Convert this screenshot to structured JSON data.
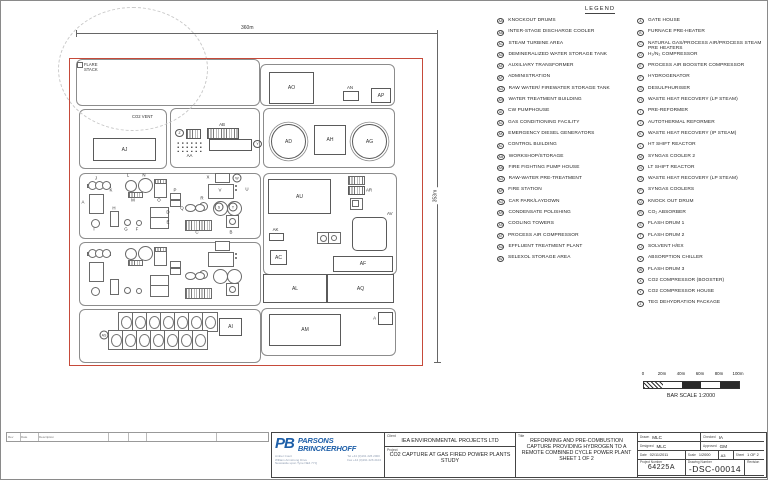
{
  "colors": {
    "boundary_red": "#c64a3a",
    "logo_blue": "#1e5fa8"
  },
  "legend": {
    "title": "LEGEND",
    "left": [
      {
        "code": "AA",
        "label": "KNOCKOUT DRUMS"
      },
      {
        "code": "AB",
        "label": "INTER-STAGE DISCHARGE COOLER"
      },
      {
        "code": "AC",
        "label": "STEAM TURBINE AREA"
      },
      {
        "code": "AD",
        "label": "DEMINERALIZED WATER STORAGE TANK"
      },
      {
        "code": "AE",
        "label": "AUXILIARY TRANSFORMER"
      },
      {
        "code": "AF",
        "label": "ADMINISTRATION"
      },
      {
        "code": "AG",
        "label": "RAW WATER/ FIREWATER STORAGE TANK"
      },
      {
        "code": "AH",
        "label": "WATER TREATMENT BUILDING"
      },
      {
        "code": "AI",
        "label": "CW PUMPHOUSE"
      },
      {
        "code": "AJ",
        "label": "GAS CONDITIONING FACILITY"
      },
      {
        "code": "AK",
        "label": "EMERGENCY DIESEL GENERATORS"
      },
      {
        "code": "AL",
        "label": "CONTROL BUILDING"
      },
      {
        "code": "AM",
        "label": "WORKSHOP/STORAGE"
      },
      {
        "code": "AN",
        "label": "FIRE FIGHTING PUMP HOUSE"
      },
      {
        "code": "AO",
        "label": "RAW-WATER PRE-TREATMENT"
      },
      {
        "code": "AP",
        "label": "FIRE STATION"
      },
      {
        "code": "AQ",
        "label": "CAR PARK/LAYDOWN"
      },
      {
        "code": "AR",
        "label": "CONDENSATE POLISHING"
      },
      {
        "code": "AS",
        "label": "COOLING TOWERS"
      },
      {
        "code": "AT",
        "label": "PROCESS AIR COMPRESSOR"
      },
      {
        "code": "AU",
        "label": "EFFLUENT TREATMENT PLANT"
      },
      {
        "code": "AV",
        "label": "SELEXOL STORAGE AREA"
      }
    ],
    "right": [
      {
        "code": "A",
        "label": "GATE HOUSE"
      },
      {
        "code": "B",
        "label": "FURNACE PRE-HEATER"
      },
      {
        "code": "C",
        "label": "NATURAL GAS/PROCESS AIR/PROCESS STEAM PRE HEATERS"
      },
      {
        "code": "D",
        "label": "H₂/N₂ COMPRESSOR"
      },
      {
        "code": "E",
        "label": "PROCESS AIR BOOSTER COMPRESSOR"
      },
      {
        "code": "F",
        "label": "HYDROGENATOR"
      },
      {
        "code": "G",
        "label": "DESULPHURISER"
      },
      {
        "code": "H",
        "label": "WASTE HEAT RECOVERY (LP STEAM)"
      },
      {
        "code": "I",
        "label": "PRE-REFORMER"
      },
      {
        "code": "J",
        "label": "AUTOTHERMAL REFORMER"
      },
      {
        "code": "K",
        "label": "WASTE HEAT RECOVERY (IP STEAM)"
      },
      {
        "code": "L",
        "label": "HT SHIFT REACTOR"
      },
      {
        "code": "M",
        "label": "SYNGAS COOLER 2"
      },
      {
        "code": "N",
        "label": "LT SHIFT REACTOR"
      },
      {
        "code": "O",
        "label": "WASTE HEAT RECOVERY (LP STEAM)"
      },
      {
        "code": "P",
        "label": "SYNGAS COOLERS"
      },
      {
        "code": "Q",
        "label": "KNOCK OUT DRUM"
      },
      {
        "code": "R",
        "label": "CO₂ ABSORBER"
      },
      {
        "code": "S",
        "label": "FLASH DRUM 1"
      },
      {
        "code": "T",
        "label": "FLASH DRUM 2"
      },
      {
        "code": "U",
        "label": "SOLVENT H/EX"
      },
      {
        "code": "V",
        "label": "ABSORPTION CHILLER"
      },
      {
        "code": "W",
        "label": "FLASH DRUM 3"
      },
      {
        "code": "X",
        "label": "CO2 COMPRESSOR (BOOSTER)"
      },
      {
        "code": "Y",
        "label": "CO2 COMPRESSOR HOUSE"
      },
      {
        "code": "Z",
        "label": "TEG DEHYDRATION PACKAGE"
      }
    ]
  },
  "scale_bar": {
    "ticks": [
      "0",
      "20m",
      "40m",
      "60m",
      "80m",
      "100m"
    ],
    "segments": [
      "zig",
      "white",
      "black",
      "white",
      "black"
    ],
    "caption": "BAR SCALE 1:2000"
  },
  "plot": {
    "width_dim": "360m",
    "height_dim": "353m",
    "flare_stack": "FLARE STACK",
    "co2_vent": "CO2 VENT",
    "containers": [
      [
        75,
        58,
        182,
        45
      ],
      [
        78,
        108,
        86,
        58
      ],
      [
        169,
        107,
        88,
        58
      ],
      [
        262,
        107,
        130,
        58
      ],
      [
        259,
        63,
        133,
        40
      ],
      [
        78,
        172,
        180,
        64
      ],
      [
        78,
        241,
        180,
        62
      ],
      [
        78,
        308,
        180,
        52
      ],
      [
        262,
        172,
        132,
        100
      ],
      [
        260,
        307,
        133,
        46
      ]
    ],
    "blocks": [
      {
        "code": "AJ",
        "x": 92,
        "y": 137,
        "w": 61,
        "h": 21,
        "lp": "in"
      },
      {
        "code": "AB",
        "x": 206,
        "y": 127,
        "w": 30,
        "h": 9,
        "lp": "above",
        "hatch": true
      },
      {
        "code": "Z",
        "x": 185,
        "y": 128,
        "w": 13,
        "h": 8,
        "lp": "left",
        "hatch": true,
        "circ": true
      },
      {
        "code": "Y",
        "x": 208,
        "y": 138,
        "w": 41,
        "h": 10,
        "lp": "right",
        "circ": true
      },
      {
        "code": "AA",
        "x": 175,
        "y": 140,
        "w": 27,
        "h": 11,
        "lp": "below",
        "dots": true
      },
      {
        "code": "AD",
        "x": 270,
        "y": 123,
        "w": 33,
        "h": 33,
        "lp": "in",
        "round": true,
        "dbl": true
      },
      {
        "code": "AH",
        "x": 313,
        "y": 124,
        "w": 30,
        "h": 28,
        "lp": "in"
      },
      {
        "code": "AG",
        "x": 351,
        "y": 123,
        "w": 33,
        "h": 33,
        "lp": "in",
        "round": true,
        "dbl": true
      },
      {
        "code": "AO",
        "x": 268,
        "y": 71,
        "w": 43,
        "h": 30,
        "lp": "in"
      },
      {
        "code": "AN",
        "x": 342,
        "y": 90,
        "w": 14,
        "h": 8,
        "lp": "above"
      },
      {
        "code": "AP",
        "x": 370,
        "y": 87,
        "w": 18,
        "h": 13,
        "lp": "in"
      },
      {
        "code": "AU",
        "x": 267,
        "y": 178,
        "w": 61,
        "h": 33,
        "lp": "in"
      },
      {
        "code": "AR",
        "x": 347,
        "y": 185,
        "w": 15,
        "h": 7,
        "lp": "right",
        "hatch": true
      },
      {
        "code": "AK",
        "x": 268,
        "y": 232,
        "w": 13,
        "h": 6,
        "lp": "above"
      },
      {
        "code": "AC",
        "x": 269,
        "y": 249,
        "w": 15,
        "h": 13,
        "lp": "in"
      },
      {
        "code": "AV",
        "x": 351,
        "y": 216,
        "w": 33,
        "h": 32,
        "lp": "ne",
        "rrect": true
      },
      {
        "code": "AF",
        "x": 332,
        "y": 255,
        "w": 58,
        "h": 14,
        "lp": "in"
      },
      {
        "code": "AL",
        "x": 262,
        "y": 273,
        "w": 62,
        "h": 27,
        "lp": "in"
      },
      {
        "code": "AQ",
        "x": 326,
        "y": 273,
        "w": 65,
        "h": 27,
        "lp": "in"
      },
      {
        "code": "AM",
        "x": 268,
        "y": 313,
        "w": 70,
        "h": 30,
        "lp": "in"
      },
      {
        "code": "A",
        "x": 377,
        "y": 311,
        "w": 13,
        "h": 11,
        "lp": "left"
      },
      {
        "code": "AI",
        "x": 218,
        "y": 317,
        "w": 21,
        "h": 16,
        "lp": "in"
      }
    ],
    "extra_shapes": [
      [
        347,
        175,
        15,
        7,
        "hatch"
      ],
      [
        349,
        197,
        11,
        10,
        "rect"
      ],
      [
        351,
        199,
        5,
        5,
        "rect"
      ],
      [
        358,
        222,
        15,
        15,
        "circle"
      ],
      [
        372,
        239,
        6,
        6,
        "circle"
      ],
      [
        316,
        231,
        11,
        10,
        "rect"
      ],
      [
        327,
        231,
        11,
        10,
        "rect"
      ],
      [
        319,
        234,
        5,
        5,
        "circle"
      ],
      [
        330,
        234,
        4,
        4,
        "circle"
      ],
      [
        211,
        140,
        35,
        6,
        "rect"
      ],
      [
        76,
        61,
        4,
        4,
        "rect"
      ]
    ],
    "train_offsets": [
      0,
      68
    ],
    "train_shapes": [
      [
        86,
        183,
        22,
        2,
        "rect"
      ],
      [
        87,
        180,
        7,
        7,
        "circle"
      ],
      [
        94,
        180,
        7,
        7,
        "circle"
      ],
      [
        101,
        180,
        7,
        7,
        "circle"
      ],
      [
        88,
        193,
        13,
        18,
        "rect"
      ],
      [
        124,
        179,
        10,
        10,
        "circle"
      ],
      [
        137,
        177,
        13,
        13,
        "circle"
      ],
      [
        127,
        191,
        13,
        4,
        "hatch"
      ],
      [
        153,
        181,
        11,
        14,
        "rect"
      ],
      [
        153,
        178,
        11,
        3,
        "hatch"
      ],
      [
        169,
        192,
        9,
        5,
        "rect"
      ],
      [
        169,
        199,
        9,
        5,
        "rect"
      ],
      [
        149,
        206,
        17,
        10,
        "rect"
      ],
      [
        149,
        216,
        17,
        10,
        "rect"
      ],
      [
        109,
        210,
        7,
        14,
        "rect"
      ],
      [
        90,
        218,
        7,
        7,
        "circle"
      ],
      [
        123,
        218,
        5,
        5,
        "circle"
      ],
      [
        135,
        219,
        4,
        4,
        "circle"
      ],
      [
        214,
        172,
        13,
        8,
        "rect"
      ],
      [
        233,
        183,
        5,
        9,
        "dots"
      ],
      [
        207,
        183,
        24,
        13,
        "rect"
      ],
      [
        198,
        201,
        7,
        7,
        "circle"
      ],
      [
        184,
        203,
        9,
        6,
        "circle"
      ],
      [
        194,
        203,
        8,
        6,
        "circle"
      ],
      [
        212,
        200,
        13,
        13,
        "circle"
      ],
      [
        226,
        200,
        13,
        13,
        "circle"
      ],
      [
        184,
        219,
        25,
        9,
        "hatch"
      ],
      [
        225,
        214,
        11,
        11,
        "rect"
      ],
      [
        228,
        217,
        5,
        5,
        "circle"
      ]
    ],
    "markers": [
      [
        "J",
        95,
        177,
        0
      ],
      [
        "K",
        110,
        189,
        0
      ],
      [
        "L",
        127,
        174,
        0
      ],
      [
        "N",
        143,
        174,
        0
      ],
      [
        "M",
        132,
        199,
        0
      ],
      [
        "O",
        158,
        199,
        0
      ],
      [
        "P",
        174,
        189,
        0
      ],
      [
        "D",
        167,
        211,
        0
      ],
      [
        "E",
        167,
        221,
        0
      ],
      [
        "H",
        113,
        207,
        0
      ],
      [
        "I",
        93,
        228,
        0
      ],
      [
        "G",
        125,
        228,
        0
      ],
      [
        "F",
        136,
        228,
        0
      ],
      [
        "A",
        82,
        201,
        0
      ],
      [
        "X",
        207,
        176,
        0
      ],
      [
        "W",
        236,
        177,
        1
      ],
      [
        "V",
        219,
        189,
        0
      ],
      [
        "U",
        246,
        188,
        0
      ],
      [
        "R",
        201,
        197,
        0
      ],
      [
        "Q",
        181,
        207,
        0
      ],
      [
        "S",
        218,
        206,
        1
      ],
      [
        "T",
        232,
        206,
        1
      ],
      [
        "C",
        196,
        231,
        0
      ],
      [
        "B",
        230,
        231,
        0
      ],
      [
        "AS",
        103,
        334,
        1
      ]
    ],
    "cooling": {
      "r1": [
        117,
        311
      ],
      "r2": [
        107,
        329
      ],
      "cols": 7,
      "cw": 14,
      "ch": 18
    }
  },
  "title_block": {
    "company": {
      "logo": "PB",
      "name1": "PARSONS",
      "name2": "BRINCKERHOFF",
      "address": [
        "Amber Court",
        "William Armstrong Drive",
        "Newcastle upon Tyne NE4 7YQ"
      ],
      "tel": "Tel  +44 (0)191 226 2000",
      "fax": "Fax  +44 (0)191 226 2104"
    },
    "client_label": "Client",
    "client": "IEA ENVIRONMENTAL PROJECTS LTD",
    "project_label": "Project",
    "project": "CO2 CAPTURE AT GAS FIRED POWER PLANTS STUDY",
    "title_label": "Title",
    "title": "REFORMING AND PRE-COMBUSTION CAPTURE PROVIDING HYDROGEN TO A REMOTE COMBINED CYCLE POWER PLANT SHEET 1 OF 2",
    "drawn_label": "Drawn",
    "drawn": "MLC",
    "checked_label": "Checked",
    "checked": "IA",
    "designed_label": "Designed",
    "designed": "MLC",
    "approved_label": "Approved",
    "approved": "GM",
    "date_label": "Date",
    "date": "02/11/2011",
    "scale_label": "Scale",
    "scale": "1/2000",
    "paper_size": "A3",
    "sheet_label": "Sheet",
    "sheet": "1 OF 2",
    "project_number_label": "Project Number",
    "project_number": "64225A",
    "drawing_number_label": "Drawing Number",
    "drawing_number": "-DSC-00014",
    "revision_label": "Revision",
    "copyright": "© Copyright Parsons Brinckerhoff"
  },
  "revision_strip": {
    "labels": [
      "Rev",
      "Date",
      "Description"
    ]
  }
}
